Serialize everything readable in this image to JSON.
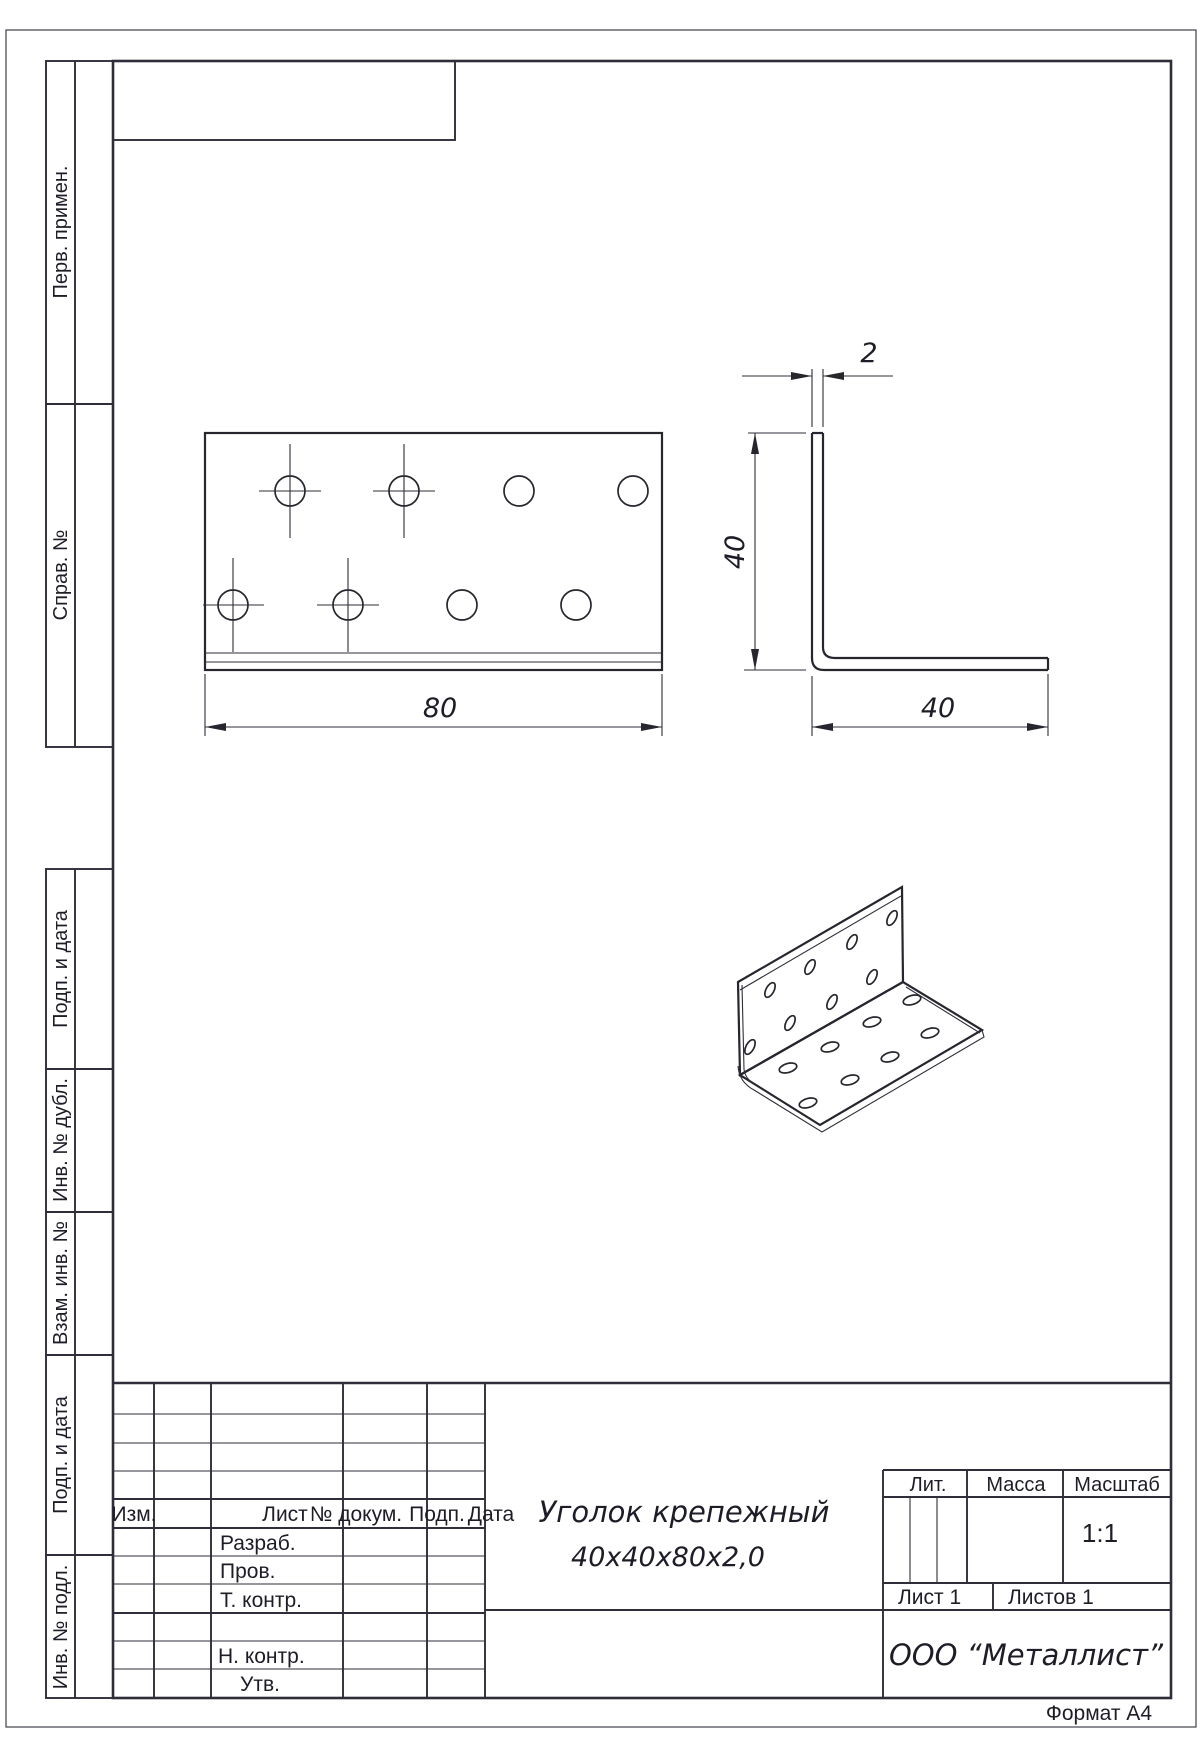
{
  "margin": {
    "perv": "Перв. примен.",
    "sprav": "Справ. №",
    "podp1": "Подп. и дата",
    "dubl": "Инв. № дубл.",
    "vzam": "Взам. инв. №",
    "podp2": "Подп. и дата",
    "podl": "Инв. № подл."
  },
  "dims": {
    "width80": "80",
    "thickness2": "2",
    "height40": "40",
    "depth40": "40"
  },
  "title_block": {
    "rev": {
      "izm": "Изм.",
      "list": "Лист",
      "doc": "№ докум.",
      "podp": "Подп.",
      "data": "Дата"
    },
    "roles": {
      "razrab": "Разраб.",
      "prov": "Пров.",
      "t_kontr": "Т. контр.",
      "n_kontr": "Н. контр.",
      "utv": "Утв."
    },
    "name_line1": "Уголок крепежный",
    "name_line2": "40х40х80х2,0",
    "lit": "Лит.",
    "massa": "Масса",
    "masshtab": "Масштаб",
    "scale_value": "1:1",
    "list_value": "Лист 1",
    "listov_value": "Листов 1",
    "company": "ООО “Металлист”"
  },
  "footer": {
    "format": "Формат А4"
  }
}
